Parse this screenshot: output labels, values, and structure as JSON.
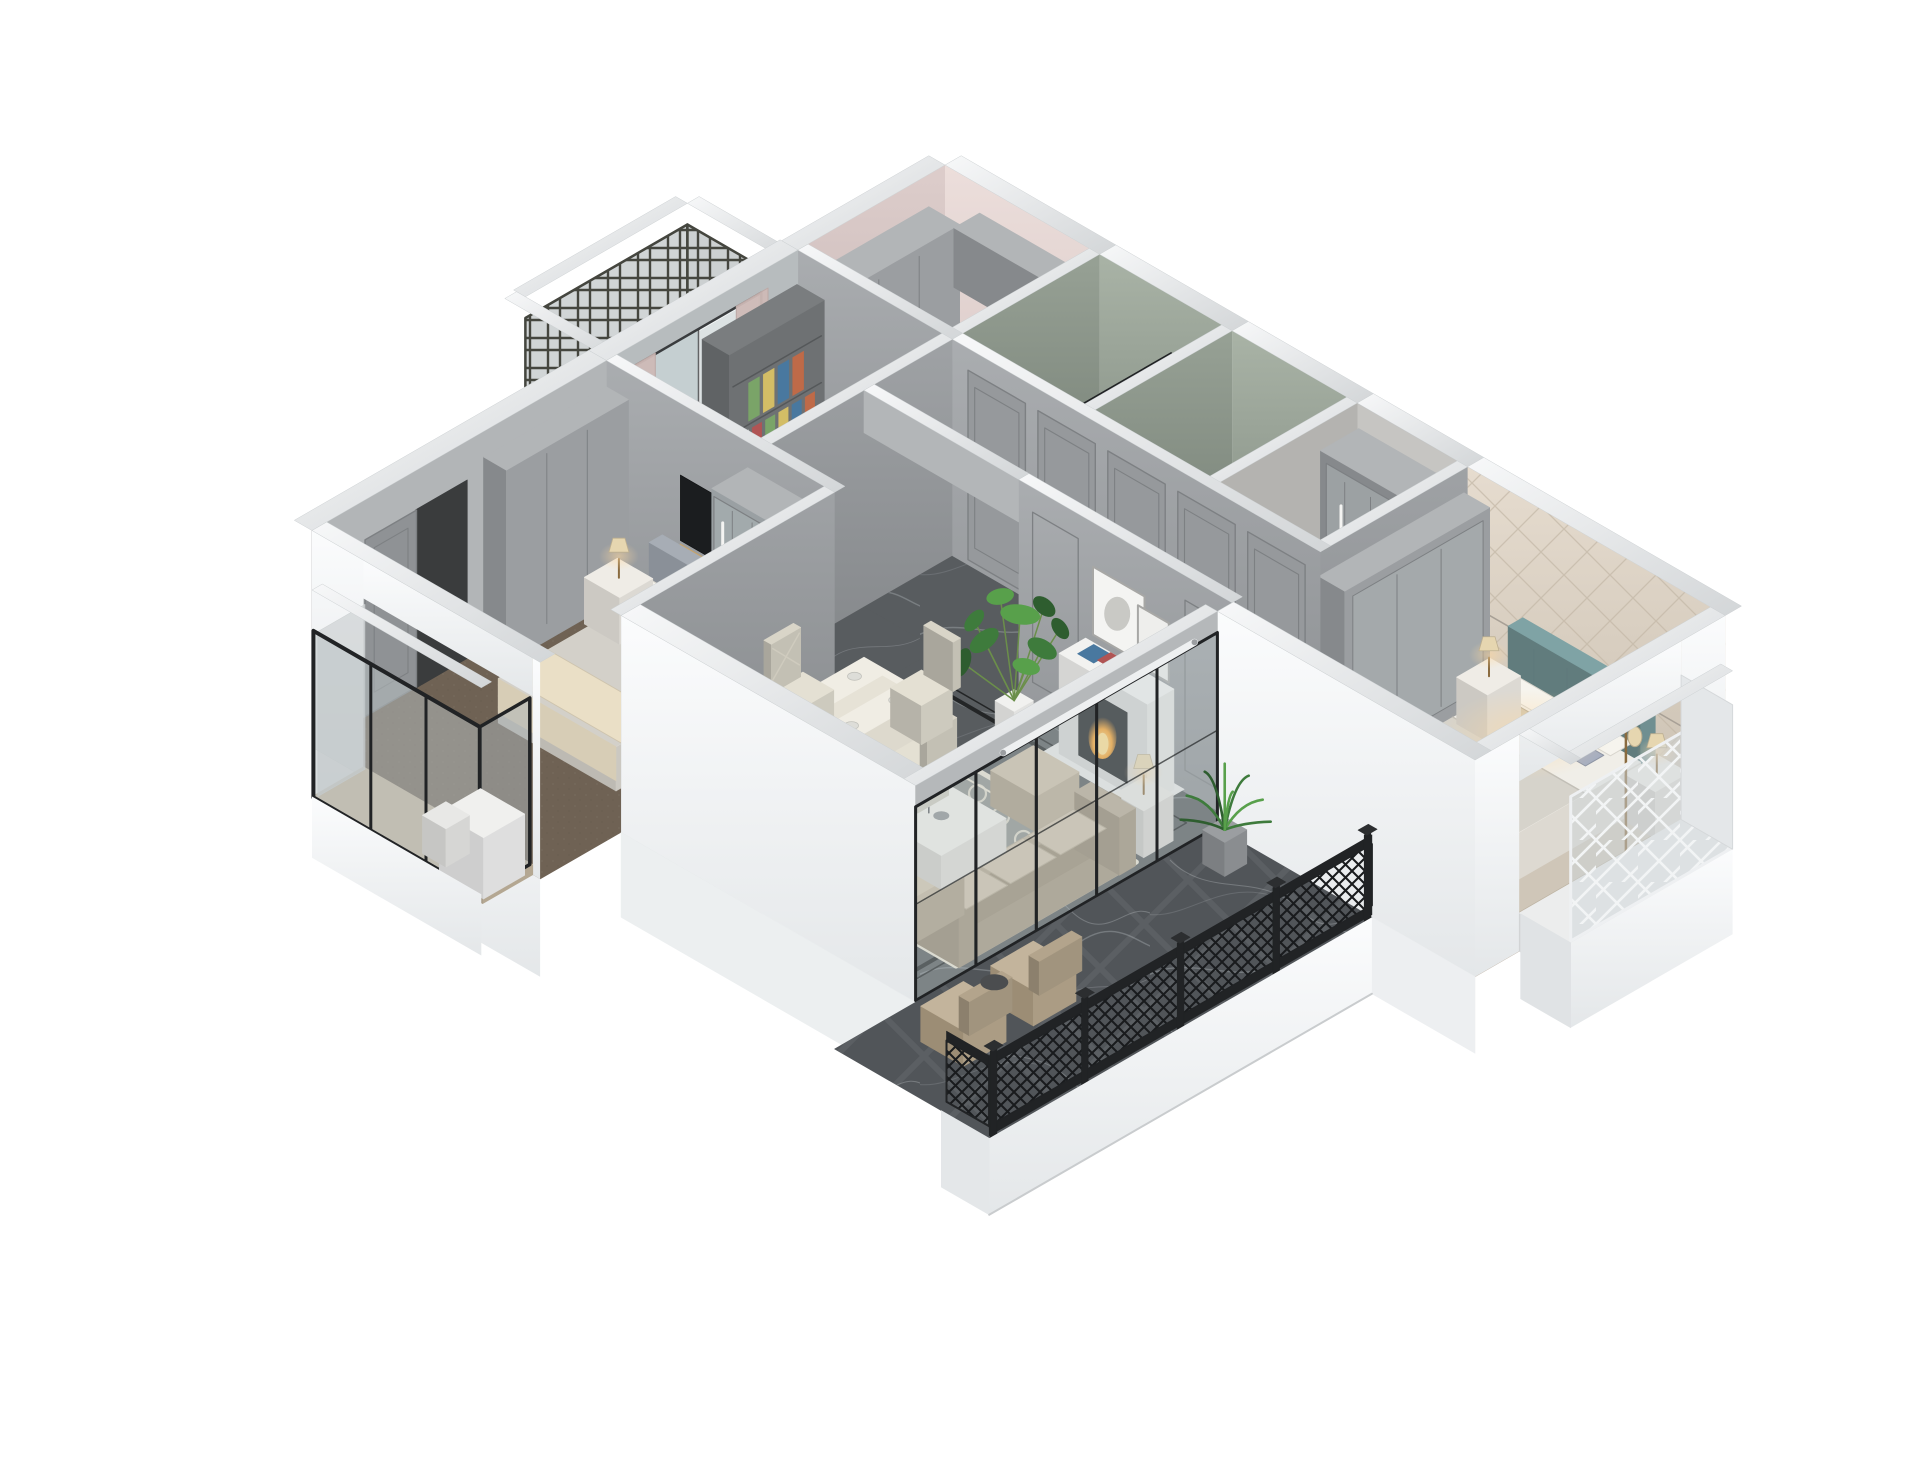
{
  "scene": {
    "type": "architectural-3d-cutaway-render",
    "description": "Isometric 3D dollhouse cutaway render of a modern grey-and-white apartment floor plan with living-dining room, master bedroom, second bedroom, study, kitchen, two bathrooms, walk-in closet, utility balcony and a large main balcony",
    "background": "#ffffff"
  },
  "palette": {
    "background": "#ffffff",
    "exteriorLight": "#fafbfc",
    "exteriorShade": "#e7e9eb",
    "wallTopLight": "#f5f6f7",
    "wallTopShade": "#d7d9db",
    "wallGray": "#a1a4a7",
    "wallGrayDeep": "#8b8e91",
    "panelLine": "#7d8083",
    "wallGreen": "#a0aa9e",
    "wallGreenDeep": "#7c867c",
    "wallPink": "#e6d8d5",
    "wallPinkDeep": "#d0c0be",
    "wallBeige": "#e0d6c9",
    "beigeLine": "#c3b7a6",
    "marbleBase": "#585c5f",
    "marbleVein": "#9aa0a4",
    "inlay": "#232526",
    "balconyBase": "#515559",
    "carpet": "#6f6254",
    "woodFloor": "#b3a693",
    "woodBay": "#c8baa2",
    "tileKitchen": "#e8e4e0",
    "tileBath": "#a9aeab",
    "tileLaundry": "#b4b7b8",
    "cabinetGray": "#9b9ea1",
    "cabinetDeep": "#86898c",
    "cabinetLight": "#b2b5b7",
    "frameBlack": "#212325",
    "latticeDark": "#45463f",
    "latticeWhite": "#f2f4f5",
    "glassTint": "#c3ced2",
    "sofaBody": "#b7a994",
    "sofaDeep": "#9b8d77",
    "cushionLight": "#cfc2ab",
    "rugBase": "#8f928e",
    "rugCream": "#e8e2d1",
    "tableCream": "#f0ede4",
    "chairCream": "#e4e0d3",
    "mantel": "#f2f2f0",
    "firebox": "#1d1f21",
    "fire": "#f5a02c",
    "plantDark": "#2e5d2f",
    "plant": "#3e7b3c",
    "plantLight": "#58a04b",
    "teal": "#7fa3a5",
    "headboardGray": "#a7adb5",
    "bedWhite": "#f0eee8",
    "duvet": "#d6d3cb",
    "throwCream": "#eadfc6",
    "pillowBlue": "#a6aec0",
    "pillowTan": "#cfc5ae",
    "lampShade": "#e6d6b0",
    "glow": "#ffd9a0",
    "tvBlack": "#1b1d1f",
    "tvGold": "#c7a36a",
    "bookColors": [
      "#bf6a48",
      "#49789f",
      "#d3bd66",
      "#7aa468",
      "#b05454",
      "#e8e8e4"
    ]
  },
  "rooms": [
    {
      "id": "kitchen",
      "label": "Kitchen"
    },
    {
      "id": "bathroom-1",
      "label": "Bathroom"
    },
    {
      "id": "bathroom-2",
      "label": "Bathroom"
    },
    {
      "id": "walk-in-closet",
      "label": "Walk-in closet"
    },
    {
      "id": "laundry-balcony",
      "label": "Utility balcony"
    },
    {
      "id": "study",
      "label": "Study bedroom"
    },
    {
      "id": "master-bedroom",
      "label": "Master bedroom"
    },
    {
      "id": "hallway",
      "label": "Entry hallway"
    },
    {
      "id": "bedroom-2",
      "label": "Second bedroom"
    },
    {
      "id": "living-dining",
      "label": "Living and dining room"
    },
    {
      "id": "balcony",
      "label": "Main balcony"
    }
  ],
  "furnishings": [
    "fireplace",
    "monstera-plant",
    "sofa-set",
    "coffee-table",
    "area-rug",
    "dining-table",
    "dining-chairs",
    "hallway-cabinet-doors",
    "master-bed",
    "master-bay-window",
    "second-bed",
    "wardrobes",
    "bookshelf",
    "balcony-railing",
    "glass-sliding-doors",
    "drying-rack",
    "desk",
    "nightstand-lamps"
  ]
}
